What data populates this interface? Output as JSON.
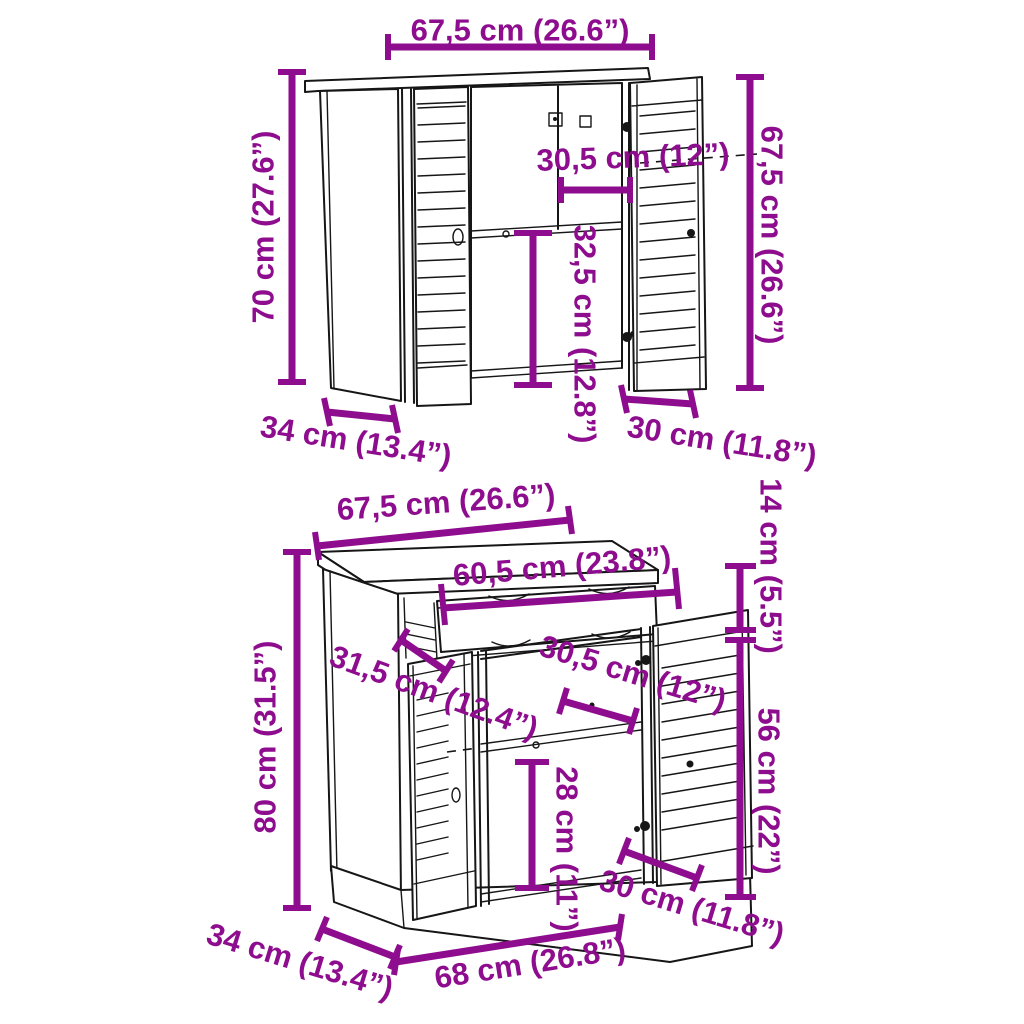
{
  "diagram": {
    "type": "furniture-dimension-drawing",
    "product": "2-piece louvered door cabinet set",
    "colors": {
      "accent": "#8E0D8E",
      "line": "#161616",
      "background": "#ffffff"
    }
  },
  "top_cabinet": {
    "name": "wall cabinet",
    "dimensions": {
      "width_top": "67,5 cm (26.6”)",
      "height_left": "70 cm (27.6”)",
      "height_right": "67,5 cm (26.6”)",
      "inner_width": "30,5 cm (12”)",
      "inner_height": "32,5 cm (12.8”)",
      "depth": "34 cm (13.4”)",
      "door_width": "30 cm (11.8”)"
    }
  },
  "bottom_cabinet": {
    "name": "sideboard cabinet",
    "dimensions": {
      "width_top": "67,5 cm (26.6”)",
      "drawer_width": "60,5 cm (23.8”)",
      "top_height": "14 cm (5.5”)",
      "door_height": "56 cm (22”)",
      "inner_depth": "31,5 cm (12.4”)",
      "inner_width": "30,5 cm (12”)",
      "inner_height": "28 cm (11”)",
      "height": "80 cm (31.5”)",
      "depth": "34 cm (13.4”)",
      "width_bottom": "68 cm (26.8”)",
      "door_width": "30 cm (11.8”)"
    }
  }
}
